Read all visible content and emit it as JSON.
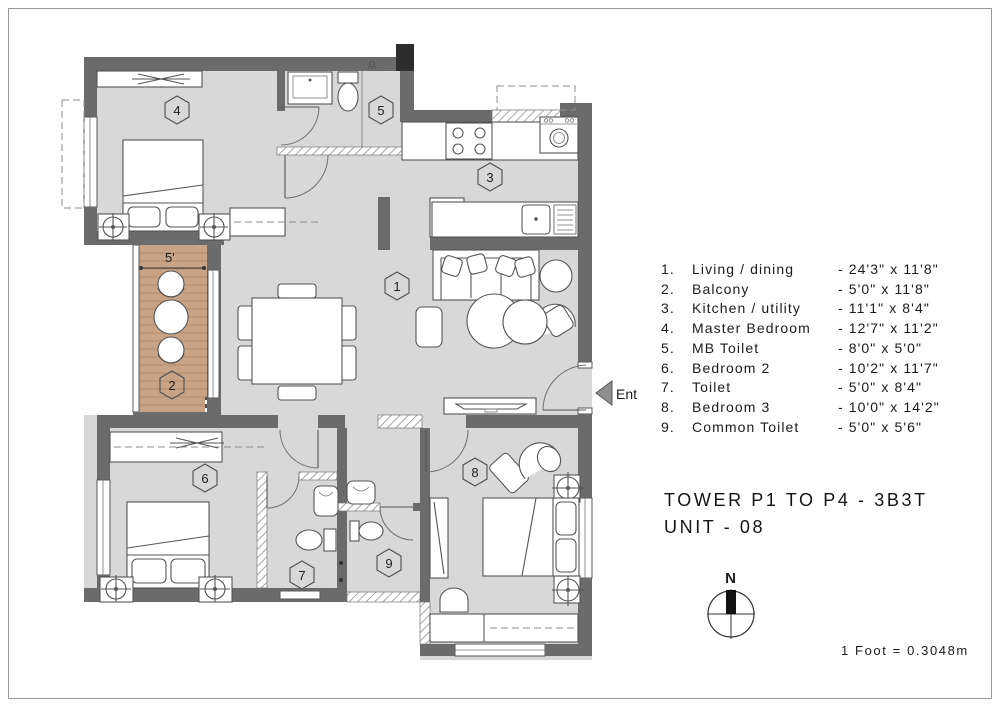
{
  "page": {
    "title_line1": "TOWER P1 TO P4 - 3B3T",
    "title_line2": "UNIT - 08",
    "scale_note": "1 Foot = 0.3048m",
    "north_label": "N"
  },
  "plan": {
    "entrance_label": "Ent",
    "balcony_width_label": "5'",
    "room_markers": [
      "1",
      "2",
      "3",
      "4",
      "5",
      "6",
      "7",
      "8",
      "9"
    ]
  },
  "legend": {
    "items": [
      {
        "num": "1.",
        "name": "Living / dining",
        "dims": "- 24'3\" x 11'8\""
      },
      {
        "num": "2.",
        "name": "Balcony",
        "dims": "- 5'0\" x 11'8\""
      },
      {
        "num": "3.",
        "name": "Kitchen / utility",
        "dims": "- 11'1\" x 8'4\""
      },
      {
        "num": "4.",
        "name": "Master Bedroom",
        "dims": "- 12'7\" x 11'2\""
      },
      {
        "num": "5.",
        "name": "MB Toilet",
        "dims": "- 8'0\" x 5'0\""
      },
      {
        "num": "6.",
        "name": "Bedroom 2",
        "dims": "- 10'2\" x 11'7\""
      },
      {
        "num": "7.",
        "name": "Toilet",
        "dims": "- 5'0\" x 8'4\""
      },
      {
        "num": "8.",
        "name": "Bedroom 3",
        "dims": "- 10'0\" x 14'2\""
      },
      {
        "num": "9.",
        "name": "Common Toilet",
        "dims": "- 5'0\" x 5'6\""
      }
    ]
  },
  "colors": {
    "wall": "#6b6b6b",
    "floor": "#d8d8d8",
    "balcony_floor": "#c9a385",
    "text": "#1c1c1c"
  }
}
